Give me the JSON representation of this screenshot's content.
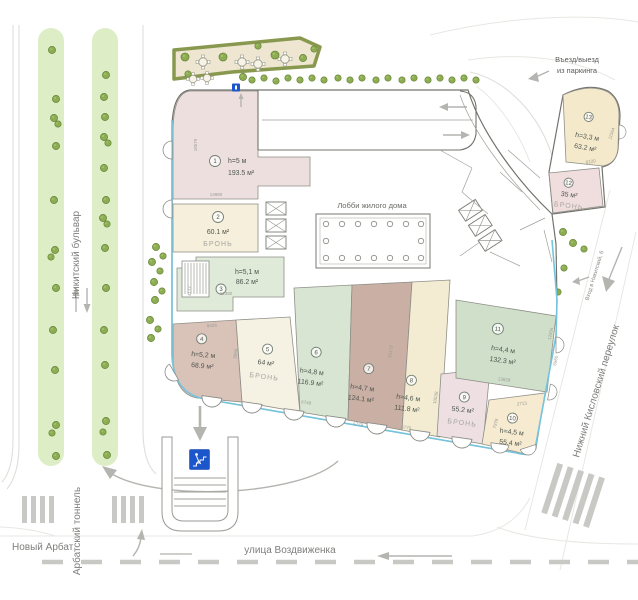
{
  "streets": {
    "nikitsky": "Никитский бульвар",
    "novy_arbat": "Новый Арбат",
    "arbat_tunnel": "Арбатский тоннель",
    "vozdvizhenka": "улица Воздвиженка",
    "kislovsky": "Нижний Кисловский переулок"
  },
  "annotations": {
    "parking1": "Въезд/выезд",
    "parking2": "из паркинга",
    "lobby": "Лобби жилого дома",
    "entrance": "Вход в Никитский, 6"
  },
  "units": [
    {
      "num": "1",
      "height": "h=5 м",
      "area": "193.5 м²",
      "status": "",
      "color": "#eddfdd"
    },
    {
      "num": "2",
      "height": "",
      "area": "60.1 м²",
      "status": "БРОНЬ",
      "color": "#f6efdb"
    },
    {
      "num": "3",
      "height": "h=5,1 м",
      "area": "86.2 м²",
      "status": "",
      "color": "#dfead9"
    },
    {
      "num": "4",
      "height": "h=5,2 м",
      "area": "68.9 м²",
      "status": "",
      "color": "#d9c2b8"
    },
    {
      "num": "5",
      "height": "",
      "area": "64 м²",
      "status": "БРОНЬ",
      "color": "#f6f2e3"
    },
    {
      "num": "6",
      "height": "h=4,8 м",
      "area": "116.9 м²",
      "status": "",
      "color": "#d7e5d2"
    },
    {
      "num": "7",
      "height": "h=4,7 м",
      "area": "124.1 м²",
      "status": "",
      "color": "#c9afa4"
    },
    {
      "num": "8",
      "height": "h=4,6 м",
      "area": "111.8 м²",
      "status": "",
      "color": "#f3ecd3"
    },
    {
      "num": "9",
      "height": "",
      "area": "55.2 м²",
      "status": "БРОНЬ",
      "color": "#eee0e2"
    },
    {
      "num": "10",
      "height": "h=4,5 м",
      "area": "55.4 м²",
      "status": "",
      "color": "#f6ead0"
    },
    {
      "num": "11",
      "height": "h=4,4 м",
      "area": "132.3 м²",
      "status": "",
      "color": "#cfdfc9"
    },
    {
      "num": "12",
      "height": "",
      "area": "35 м²",
      "status": "БРОНЬ",
      "color": "#f0dede"
    },
    {
      "num": "13",
      "height": "h=3,3 м",
      "area": "63.2 м²",
      "status": "",
      "color": "#f5e9cc"
    }
  ],
  "dimensions": [
    "18579",
    "13980",
    "12380",
    "4177",
    "8426",
    "3980",
    "6748",
    "6779",
    "6770",
    "10538",
    "10172",
    "2713",
    "7978",
    "13628",
    "6980",
    "12934",
    "8120",
    "11564"
  ],
  "colors": {
    "facade": "#74c4dd",
    "green_strip": "#ddeec6",
    "tree": "#8dad52"
  }
}
